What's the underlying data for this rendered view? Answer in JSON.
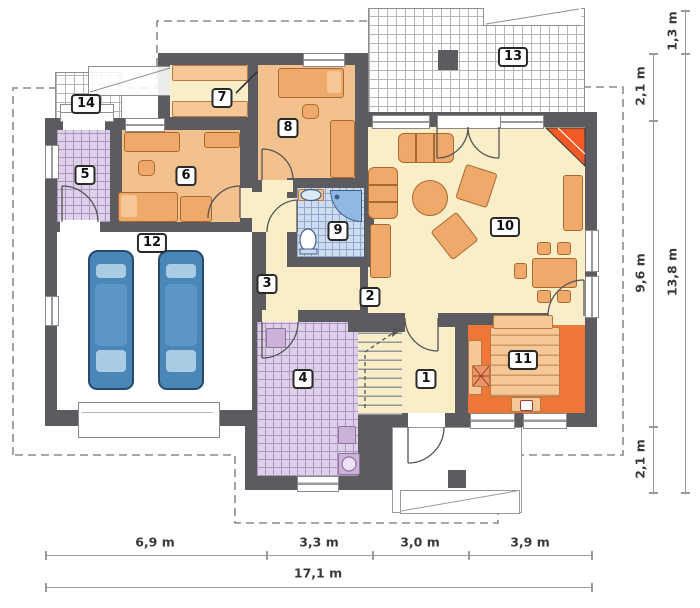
{
  "plan_title": "single-storey house floor plan",
  "room_labels": [
    "1",
    "2",
    "3",
    "4",
    "5",
    "6",
    "7",
    "8",
    "9",
    "10",
    "11",
    "12",
    "13",
    "14"
  ],
  "dimensions": {
    "bottom_segments": [
      "6,9 m",
      "3,3 m",
      "3,0 m",
      "3,9 m"
    ],
    "bottom_total": "17,1 m",
    "right_inner_top": "2,1 m",
    "right_inner_middle": "9,6 m",
    "right_inner_bottom": "2,1 m",
    "right_outer_top": "1,3 m",
    "right_outer_total": "13,8 m"
  },
  "colors": {
    "wall": "#5c5c60",
    "floor_cream": "#faeec9",
    "floor_peach": "#f2c18d",
    "kitchen_orange": "#ee7637",
    "tile_lavender": "#ddd0e8",
    "tile_blue": "#cfdcf0",
    "car_blue": "#4a86b8",
    "fireplace_orange": "#f15a24",
    "dimension_line": "#9a9a9a"
  }
}
